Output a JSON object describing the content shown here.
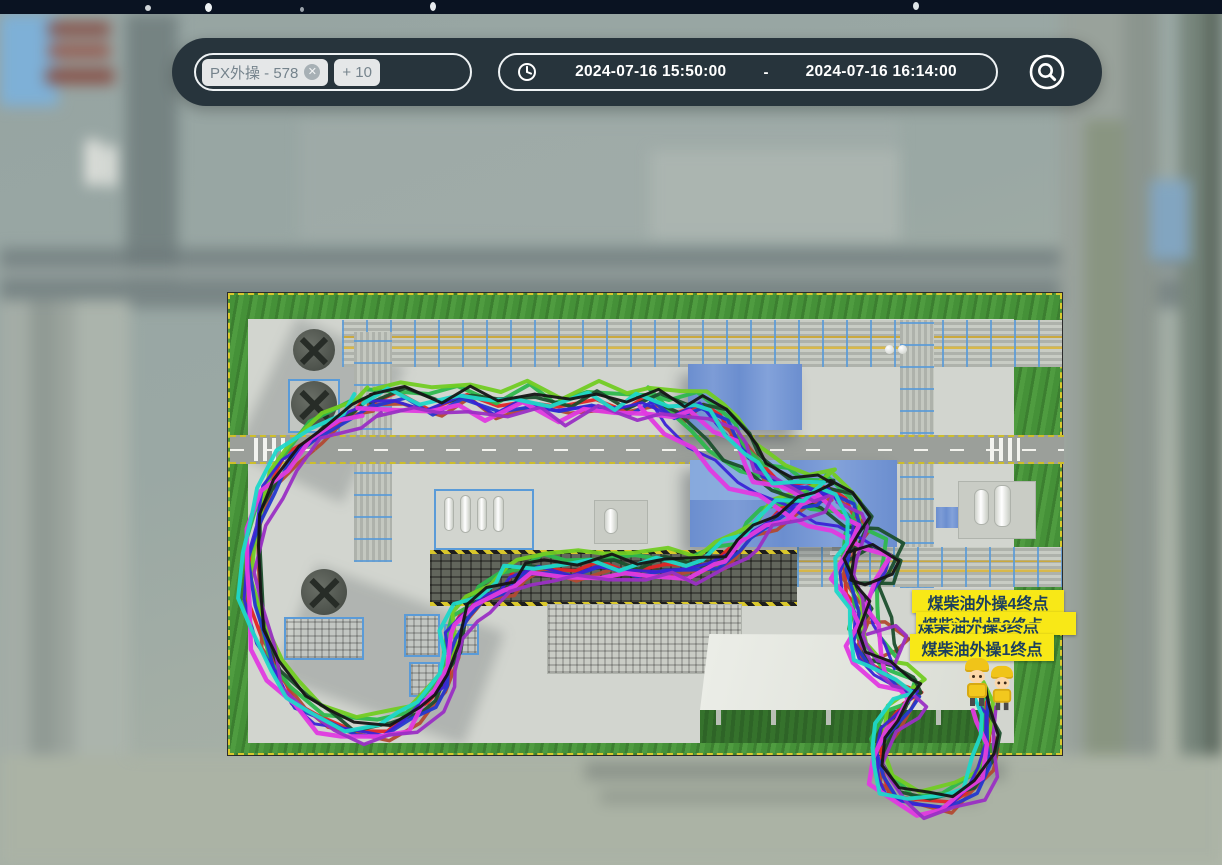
{
  "toolbar": {
    "filter": {
      "chips": [
        {
          "label": "PX外操 - 578",
          "close_icon": "x-circle"
        },
        {
          "label": "+ 10"
        }
      ]
    },
    "time_range": {
      "icon": "clock",
      "start": "2024-07-16 15:50:00",
      "separator": "-",
      "end": "2024-07-16 16:14:00"
    },
    "locate_icon": "circle-magnifier"
  },
  "map": {
    "labels": [
      {
        "text": "煤柴油外操4终点",
        "occluded": false
      },
      {
        "text": "煤柴油外操2终点",
        "occluded": true
      },
      {
        "text": "煤柴油外操3终点",
        "occluded": true
      },
      {
        "text": "煤柴油外操1终点",
        "occluded": false
      }
    ],
    "avatars": {
      "count": 2,
      "type": "worker-cartoon"
    },
    "colors": {
      "label_bg": "#f8e817",
      "label_text": "#1c3f5e",
      "toolbar_bg": "#27343c",
      "grass": "#459138",
      "blue_building": "#6d8fd0"
    },
    "segments": {
      "loop": [
        [
          368,
          402
        ],
        [
          400,
          396
        ],
        [
          432,
          406
        ],
        [
          464,
          396
        ],
        [
          496,
          408
        ],
        [
          528,
          398
        ],
        [
          560,
          410
        ],
        [
          592,
          399
        ],
        [
          624,
          408
        ],
        [
          650,
          400
        ],
        [
          676,
          410
        ],
        [
          700,
          404
        ],
        [
          722,
          418
        ],
        [
          738,
          436
        ],
        [
          750,
          455
        ],
        [
          764,
          470
        ],
        [
          786,
          482
        ],
        [
          808,
          486
        ],
        [
          828,
          488
        ],
        [
          812,
          499
        ],
        [
          790,
          507
        ],
        [
          768,
          519
        ],
        [
          750,
          534
        ],
        [
          734,
          548
        ],
        [
          716,
          560
        ],
        [
          692,
          568
        ],
        [
          662,
          565
        ],
        [
          632,
          569
        ],
        [
          602,
          565
        ],
        [
          572,
          569
        ],
        [
          542,
          567
        ],
        [
          518,
          573
        ],
        [
          505,
          585
        ],
        [
          483,
          597
        ],
        [
          464,
          612
        ],
        [
          453,
          630
        ],
        [
          451,
          655
        ],
        [
          445,
          680
        ],
        [
          430,
          700
        ],
        [
          410,
          718
        ],
        [
          384,
          729
        ],
        [
          352,
          730
        ],
        [
          322,
          719
        ],
        [
          296,
          699
        ],
        [
          275,
          671
        ],
        [
          261,
          637
        ],
        [
          252,
          597
        ],
        [
          250,
          557
        ],
        [
          257,
          519
        ],
        [
          269,
          486
        ],
        [
          289,
          457
        ],
        [
          316,
          432
        ],
        [
          350,
          413
        ],
        [
          368,
          402
        ]
      ],
      "descent": [
        [
          828,
          488
        ],
        [
          848,
          502
        ],
        [
          860,
          520
        ],
        [
          852,
          544
        ],
        [
          842,
          566
        ],
        [
          850,
          590
        ],
        [
          860,
          612
        ],
        [
          854,
          636
        ],
        [
          863,
          658
        ],
        [
          882,
          672
        ],
        [
          903,
          683
        ],
        [
          918,
          692
        ],
        [
          905,
          707
        ],
        [
          888,
          724
        ],
        [
          878,
          748
        ],
        [
          880,
          772
        ],
        [
          893,
          792
        ],
        [
          918,
          803
        ],
        [
          948,
          801
        ],
        [
          972,
          787
        ],
        [
          986,
          764
        ],
        [
          989,
          738
        ],
        [
          986,
          714
        ],
        [
          982,
          697
        ]
      ],
      "diagonal": [
        [
          650,
          400
        ],
        [
          672,
          420
        ],
        [
          695,
          443
        ],
        [
          716,
          461
        ],
        [
          740,
          476
        ],
        [
          764,
          491
        ],
        [
          790,
          504
        ],
        [
          816,
          516
        ],
        [
          842,
          526
        ],
        [
          868,
          535
        ],
        [
          893,
          549
        ],
        [
          886,
          572
        ],
        [
          874,
          594
        ],
        [
          880,
          620
        ],
        [
          886,
          645
        ],
        [
          896,
          662
        ]
      ],
      "knot_a": [
        [
          845,
          560
        ],
        [
          868,
          554
        ],
        [
          889,
          564
        ],
        [
          886,
          584
        ],
        [
          863,
          592
        ],
        [
          844,
          584
        ],
        [
          845,
          560
        ]
      ],
      "knot_b": [
        [
          858,
          620
        ],
        [
          882,
          614
        ],
        [
          899,
          629
        ],
        [
          890,
          649
        ],
        [
          866,
          652
        ],
        [
          854,
          636
        ],
        [
          858,
          620
        ]
      ]
    },
    "trails": [
      {
        "id": "t1",
        "color": "#e02525",
        "width": 3.5,
        "offset": [
          0,
          0
        ],
        "jitter": 4,
        "seed": 1,
        "segments": [
          "loop",
          "descent"
        ]
      },
      {
        "id": "t2",
        "color": "#b24a31",
        "width": 3.5,
        "offset": [
          5,
          7
        ],
        "jitter": 5,
        "seed": 2,
        "segments": [
          "loop",
          "descent",
          "knot_b"
        ]
      },
      {
        "id": "t3",
        "color": "#2eb84d",
        "width": 4,
        "offset": [
          -2,
          -9
        ],
        "jitter": 5,
        "seed": 3,
        "segments": [
          "loop",
          "diagonal",
          "descent"
        ]
      },
      {
        "id": "t4",
        "color": "#72cc23",
        "width": 4,
        "offset": [
          3,
          -15
        ],
        "jitter": 4,
        "seed": 4,
        "segments": [
          "loop",
          "descent"
        ]
      },
      {
        "id": "t5",
        "color": "#1c4f2d",
        "width": 3.5,
        "offset": [
          7,
          -4
        ],
        "jitter": 5,
        "seed": 5,
        "segments": [
          "loop",
          "diagonal",
          "descent",
          "knot_a"
        ]
      },
      {
        "id": "t6",
        "color": "#2438cf",
        "width": 3.5,
        "offset": [
          2,
          5
        ],
        "jitter": 4,
        "seed": 6,
        "segments": [
          "loop",
          "descent"
        ]
      },
      {
        "id": "t7",
        "color": "#3a23d6",
        "width": 3,
        "offset": [
          -4,
          3
        ],
        "jitter": 4,
        "seed": 7,
        "segments": [
          "loop",
          "diagonal",
          "descent"
        ]
      },
      {
        "id": "t8",
        "color": "#e03ae0",
        "width": 4.5,
        "offset": [
          -6,
          9
        ],
        "jitter": 5,
        "seed": 8,
        "segments": [
          "loop",
          "diagonal",
          "descent"
        ]
      },
      {
        "id": "t9",
        "color": "#9a2fc4",
        "width": 3.5,
        "offset": [
          9,
          11
        ],
        "jitter": 5,
        "seed": 9,
        "segments": [
          "loop",
          "descent",
          "knot_b"
        ]
      },
      {
        "id": "t10",
        "color": "#1fd7c9",
        "width": 4,
        "offset": [
          -9,
          -3
        ],
        "jitter": 5,
        "seed": 10,
        "segments": [
          "loop",
          "descent"
        ]
      },
      {
        "id": "t11",
        "color": "#151515",
        "width": 3,
        "offset": [
          6,
          -7
        ],
        "jitter": 4,
        "seed": 11,
        "segments": [
          "loop",
          "descent",
          "knot_a"
        ]
      }
    ]
  }
}
